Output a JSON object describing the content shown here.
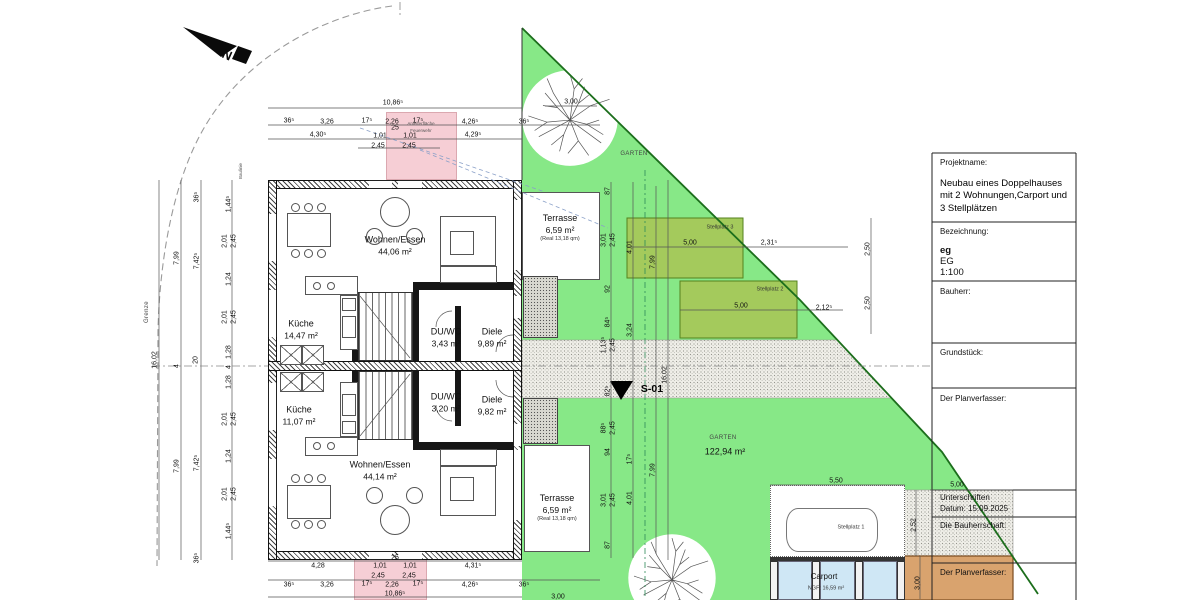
{
  "north_label": "N",
  "colors": {
    "green": "#87e887",
    "olive": "#a4ca5c",
    "olive_border": "#55821e",
    "boundary_line": "#1c6e1c",
    "pink": "#f6ced5",
    "tan": "#d9a36e",
    "glass": "#cfe7f5"
  },
  "title_block": {
    "projektname_label": "Projektname:",
    "projektname": "Neubau eines Doppelhauses mit 2 Wohnungen,Carport und 3 Stellplätzen",
    "bezeichnung_label": "Bezeichnung:",
    "bezeichnung_code": "eg",
    "bezeichnung_name": "EG",
    "massstab": "1:100",
    "bauherr_label": "Bauherr:",
    "grundstueck_label": "Grundstück:",
    "planverfasser_label": "Der Planverfasser:",
    "unterschriften_label": "Unterschriften",
    "datum": "Datum: 15.09.2025",
    "bauherrschaft_label": "Die Bauherrschaft:",
    "planverfasser2_label": "Der Planverfasser:"
  },
  "rooms": [
    {
      "lines": [
        "Wohnen/Essen",
        "44,06 m²"
      ],
      "x": 395,
      "y": 246
    },
    {
      "lines": [
        "Küche",
        "14,47 m²"
      ],
      "x": 301,
      "y": 330
    },
    {
      "lines": [
        "DU/WC",
        "3,43 m²"
      ],
      "x": 446,
      "y": 338
    },
    {
      "lines": [
        "Diele",
        "9,89 m²"
      ],
      "x": 492,
      "y": 338
    },
    {
      "lines": [
        "Terrasse",
        "6,59 m²",
        "(Real 13,18 qm)"
      ],
      "x": 560,
      "y": 228
    },
    {
      "lines": [
        "Küche",
        "11,07 m²"
      ],
      "x": 299,
      "y": 416
    },
    {
      "lines": [
        "DU/WC",
        "3,20 m²"
      ],
      "x": 446,
      "y": 403
    },
    {
      "lines": [
        "Diele",
        "9,82 m²"
      ],
      "x": 492,
      "y": 406
    },
    {
      "lines": [
        "Wohnen/Essen",
        "44,14 m²"
      ],
      "x": 380,
      "y": 471
    },
    {
      "lines": [
        "Terrasse",
        "6,59 m²",
        "(Real 13,18 qm)"
      ],
      "x": 557,
      "y": 508
    }
  ],
  "labels": [
    {
      "text": "GARTEN",
      "x": 634,
      "y": 154,
      "cls": "t-tiny"
    },
    {
      "text": "GARTEN",
      "x": 723,
      "y": 438,
      "cls": "t-tiny"
    },
    {
      "text": "122,94 m²",
      "x": 725,
      "y": 452,
      "cls": "t-area"
    },
    {
      "text": "Stellplatz 3",
      "x": 720,
      "y": 228,
      "cls": "t-micro"
    },
    {
      "text": "Stellplatz 2",
      "x": 770,
      "y": 290,
      "cls": "t-micro"
    },
    {
      "text": "Stellplatz 1",
      "x": 851,
      "y": 528,
      "cls": "t-micro"
    },
    {
      "text": "Carport",
      "x": 824,
      "y": 577,
      "cls": "t-small"
    },
    {
      "text": "NGF: 16,59 m²",
      "x": 826,
      "y": 589,
      "cls": "t-micro"
    },
    {
      "text": "Anleiterfläche",
      "x": 421,
      "y": 124,
      "cls": "t-nano"
    },
    {
      "text": "Feuerwehr",
      "x": 421,
      "y": 131,
      "cls": "t-nano"
    },
    {
      "text": "Grenze",
      "x": 147,
      "y": 312,
      "cls": "t-tiny",
      "r": -90
    },
    {
      "text": "Baulinie",
      "x": 241,
      "y": 171,
      "cls": "t-nano",
      "r": -90
    },
    {
      "text": "S-01",
      "x": 652,
      "y": 389,
      "cls": "t-section"
    }
  ],
  "dimensions": [
    {
      "text": "10,86⁵",
      "x": 393,
      "y": 103
    },
    {
      "text": "36⁵",
      "x": 289,
      "y": 121
    },
    {
      "text": "3,26",
      "x": 327,
      "y": 122
    },
    {
      "text": "17⁵",
      "x": 367,
      "y": 121
    },
    {
      "text": "2,26",
      "x": 392,
      "y": 122
    },
    {
      "text": "17⁵",
      "x": 418,
      "y": 121
    },
    {
      "text": "4,26⁵",
      "x": 470,
      "y": 122
    },
    {
      "text": "36⁵",
      "x": 524,
      "y": 122
    },
    {
      "text": "3,00",
      "x": 571,
      "y": 102
    },
    {
      "text": "4,30⁵",
      "x": 318,
      "y": 135
    },
    {
      "text": "1,01",
      "x": 380,
      "y": 136
    },
    {
      "text": "25",
      "x": 395,
      "y": 128
    },
    {
      "text": "1,01",
      "x": 410,
      "y": 136
    },
    {
      "text": "4,29⁵",
      "x": 473,
      "y": 135
    },
    {
      "text": "2,45",
      "x": 378,
      "y": 146
    },
    {
      "text": "2,45",
      "x": 409,
      "y": 146
    },
    {
      "text": "4,28",
      "x": 318,
      "y": 566
    },
    {
      "text": "1,01",
      "x": 380,
      "y": 566
    },
    {
      "text": "25",
      "x": 395,
      "y": 558
    },
    {
      "text": "1,01",
      "x": 410,
      "y": 566
    },
    {
      "text": "4,31⁵",
      "x": 473,
      "y": 566
    },
    {
      "text": "2,45",
      "x": 378,
      "y": 576
    },
    {
      "text": "2,45",
      "x": 409,
      "y": 576
    },
    {
      "text": "36⁵",
      "x": 289,
      "y": 585
    },
    {
      "text": "3,26",
      "x": 327,
      "y": 585
    },
    {
      "text": "17⁵",
      "x": 367,
      "y": 584
    },
    {
      "text": "2,26",
      "x": 392,
      "y": 585
    },
    {
      "text": "17⁵",
      "x": 418,
      "y": 584
    },
    {
      "text": "4,26⁵",
      "x": 470,
      "y": 585
    },
    {
      "text": "36⁵",
      "x": 524,
      "y": 585
    },
    {
      "text": "10,86⁵",
      "x": 395,
      "y": 594
    },
    {
      "text": "3,00",
      "x": 558,
      "y": 597
    },
    {
      "text": "16,02",
      "x": 155,
      "y": 360,
      "r": -90
    },
    {
      "text": "7,99",
      "x": 177,
      "y": 258,
      "r": -90
    },
    {
      "text": "4",
      "x": 177,
      "y": 366,
      "r": -90
    },
    {
      "text": "20",
      "x": 196,
      "y": 360,
      "r": -90
    },
    {
      "text": "36⁵",
      "x": 197,
      "y": 197,
      "r": -90
    },
    {
      "text": "7,42⁵",
      "x": 197,
      "y": 261,
      "r": -90
    },
    {
      "text": "7,42⁵",
      "x": 197,
      "y": 463,
      "r": -90
    },
    {
      "text": "7,99",
      "x": 177,
      "y": 466,
      "r": -90
    },
    {
      "text": "36⁵",
      "x": 197,
      "y": 558,
      "r": -90
    },
    {
      "text": "1,44⁵",
      "x": 229,
      "y": 204,
      "r": -90
    },
    {
      "text": "2,01",
      "x": 225,
      "y": 241,
      "r": -90
    },
    {
      "text": "2,45",
      "x": 234,
      "y": 241,
      "r": -90
    },
    {
      "text": "1,24",
      "x": 229,
      "y": 279,
      "r": -90
    },
    {
      "text": "2,01",
      "x": 225,
      "y": 317,
      "r": -90
    },
    {
      "text": "2,45",
      "x": 234,
      "y": 317,
      "r": -90
    },
    {
      "text": "1,28",
      "x": 229,
      "y": 352,
      "r": -90
    },
    {
      "text": "4",
      "x": 229,
      "y": 367,
      "r": -90
    },
    {
      "text": "1,28",
      "x": 229,
      "y": 382,
      "r": -90
    },
    {
      "text": "2,01",
      "x": 225,
      "y": 419,
      "r": -90
    },
    {
      "text": "2,45",
      "x": 234,
      "y": 419,
      "r": -90
    },
    {
      "text": "1,24",
      "x": 229,
      "y": 456,
      "r": -90
    },
    {
      "text": "2,01",
      "x": 225,
      "y": 494,
      "r": -90
    },
    {
      "text": "2,45",
      "x": 234,
      "y": 494,
      "r": -90
    },
    {
      "text": "1,44⁵",
      "x": 229,
      "y": 531,
      "r": -90
    },
    {
      "text": "87",
      "x": 608,
      "y": 191,
      "r": -90
    },
    {
      "text": "3,01",
      "x": 604,
      "y": 240,
      "r": -90
    },
    {
      "text": "2,45",
      "x": 613,
      "y": 240,
      "r": -90
    },
    {
      "text": "92",
      "x": 608,
      "y": 289,
      "r": -90
    },
    {
      "text": "84⁵",
      "x": 608,
      "y": 322,
      "r": -90
    },
    {
      "text": "1,13⁵",
      "x": 604,
      "y": 345,
      "r": -90
    },
    {
      "text": "2,45",
      "x": 613,
      "y": 345,
      "r": -90
    },
    {
      "text": "82⁵",
      "x": 608,
      "y": 391,
      "r": -90
    },
    {
      "text": "88⁵",
      "x": 604,
      "y": 428,
      "r": -90
    },
    {
      "text": "2,45",
      "x": 613,
      "y": 428,
      "r": -90
    },
    {
      "text": "94",
      "x": 608,
      "y": 452,
      "r": -90
    },
    {
      "text": "3,01",
      "x": 604,
      "y": 500,
      "r": -90
    },
    {
      "text": "2,45",
      "x": 613,
      "y": 500,
      "r": -90
    },
    {
      "text": "87",
      "x": 608,
      "y": 545,
      "r": -90
    },
    {
      "text": "4,01",
      "x": 630,
      "y": 247,
      "r": -90
    },
    {
      "text": "3,24",
      "x": 630,
      "y": 330,
      "r": -90
    },
    {
      "text": "17⁵",
      "x": 630,
      "y": 459,
      "r": -90
    },
    {
      "text": "4,01",
      "x": 630,
      "y": 498,
      "r": -90
    },
    {
      "text": "7,99",
      "x": 653,
      "y": 262,
      "r": -90
    },
    {
      "text": "7,99",
      "x": 653,
      "y": 470,
      "r": -90
    },
    {
      "text": "16,02",
      "x": 665,
      "y": 375,
      "r": -90
    },
    {
      "text": "5,00",
      "x": 690,
      "y": 243
    },
    {
      "text": "2,31⁵",
      "x": 769,
      "y": 243
    },
    {
      "text": "5,00",
      "x": 741,
      "y": 306
    },
    {
      "text": "2,12⁵",
      "x": 824,
      "y": 308
    },
    {
      "text": "2,50",
      "x": 868,
      "y": 249,
      "r": -90
    },
    {
      "text": "2,50",
      "x": 868,
      "y": 303,
      "r": -90
    },
    {
      "text": "5,50",
      "x": 836,
      "y": 481
    },
    {
      "text": "5,00",
      "x": 957,
      "y": 485
    },
    {
      "text": "2,52",
      "x": 914,
      "y": 525,
      "r": -90
    },
    {
      "text": "3,00",
      "x": 918,
      "y": 583,
      "r": -90
    }
  ],
  "dim_lines": [
    [
      268,
      108,
      522,
      108
    ],
    [
      268,
      125,
      600,
      125
    ],
    [
      268,
      139,
      522,
      139
    ],
    [
      358,
      148,
      440,
      148
    ],
    [
      545,
      106,
      597,
      106
    ],
    [
      159,
      180,
      159,
      560
    ],
    [
      181,
      180,
      181,
      560
    ],
    [
      201,
      180,
      201,
      560
    ],
    [
      232,
      180,
      232,
      560
    ],
    [
      268,
      561,
      522,
      561
    ],
    [
      268,
      580,
      600,
      580
    ],
    [
      268,
      597,
      522,
      597
    ],
    [
      611,
      182,
      611,
      558
    ],
    [
      633,
      182,
      633,
      558
    ],
    [
      656,
      186,
      656,
      554
    ],
    [
      668,
      180,
      668,
      560
    ],
    [
      627,
      247,
      848,
      247
    ],
    [
      680,
      310,
      843,
      310
    ],
    [
      871,
      218,
      871,
      334
    ],
    [
      770,
      485,
      905,
      485
    ],
    [
      930,
      490,
      1013,
      490
    ],
    [
      916,
      490,
      916,
      556
    ],
    [
      920,
      556,
      920,
      599
    ]
  ],
  "aux_lines": {
    "dashdot": [
      [
        152,
        366,
        268,
        366
      ],
      [
        522,
        366,
        933,
        366
      ],
      [
        400,
        2,
        400,
        15
      ]
    ],
    "teal": [
      [
        645,
        170,
        645,
        598
      ]
    ],
    "blue": [
      [
        360,
        128,
        545,
        192
      ],
      [
        420,
        150,
        608,
        228
      ]
    ]
  }
}
